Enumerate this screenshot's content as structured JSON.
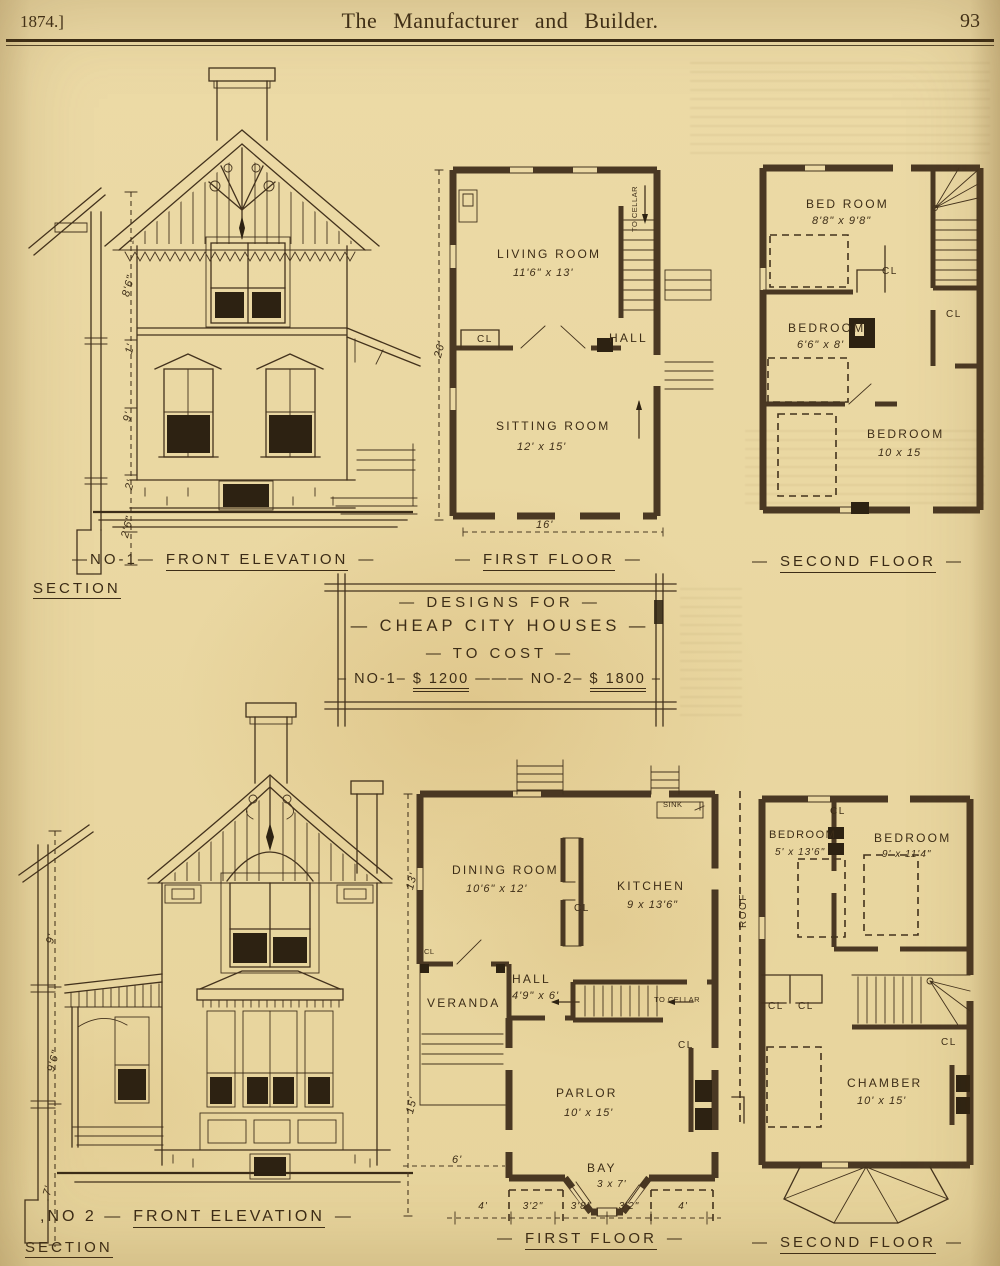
{
  "header": {
    "year": "1874.]",
    "title": "The Manufacturer and Builder.",
    "page_number": "93"
  },
  "title_box": {
    "line1": "— DESIGNS FOR —",
    "line2": "— CHEAP CITY HOUSES —",
    "line3": "— TO COST —",
    "cost1_label": "– NO-1–",
    "cost1_amount": "$ 1200",
    "separator": "———",
    "cost2_label": "NO-2–",
    "cost2_amount": "$ 1800",
    "end_dash": "–"
  },
  "captions": {
    "dash": "—",
    "elev1_no": "—NO-1—",
    "elev2_no": ",NO 2 —",
    "front_elevation": "FRONT ELEVATION",
    "section": "SECTION",
    "first_floor": "FIRST FLOOR",
    "second_floor": "SECOND FLOOR"
  },
  "plan1_first": {
    "living_room": {
      "name": "LIVING ROOM",
      "dims": "11'6\" x 13'"
    },
    "sitting_room": {
      "name": "SITTING ROOM",
      "dims": "12' x 15'"
    },
    "hall": "HALL",
    "closet": "CL",
    "to_cellar": "TO CELLAR",
    "width_dim": "16'",
    "height_dim": "26'"
  },
  "plan1_second": {
    "bedroom1": {
      "name": "BED ROOM",
      "dims": "8'8\" x 9'8\""
    },
    "bedroom2": {
      "name": "BEDROOM",
      "dims": "6'6\" x 8'"
    },
    "bedroom3": {
      "name": "BEDROOM",
      "dims": "10 x 15"
    },
    "closet": "CL"
  },
  "plan2_first": {
    "dining_room": {
      "name": "DINING ROOM",
      "dims": "10'6\" x 12'"
    },
    "kitchen": {
      "name": "KITCHEN",
      "dims": "9 x 13'6\""
    },
    "hall": {
      "name": "HALL",
      "dims": "4'9\" x 6'"
    },
    "veranda": "VERANDA",
    "parlor": {
      "name": "PARLOR",
      "dims": "10' x 15'"
    },
    "bay": {
      "name": "BAY",
      "dims": "3 x 7'"
    },
    "sink": "SINK",
    "to_cellar": "TO CELLAR",
    "closet": "CL",
    "left_dim_top": "13'",
    "left_dim_bottom": "15'",
    "veranda_dim": "6'",
    "bottom_dims": [
      "4'",
      "3'2\"",
      "3'8\"",
      "3'2\"",
      "4'"
    ]
  },
  "plan2_second": {
    "bedroom1": {
      "name": "BEDROOM",
      "dims": "5' x 13'6\""
    },
    "bedroom2": {
      "name": "BEDROOM",
      "dims": "9' x 11'4\""
    },
    "chamber": {
      "name": "CHAMBER",
      "dims": "10' x 15'"
    },
    "roof": "ROOF",
    "closet": "CL"
  },
  "sections": {
    "no1_dims": [
      "8'6\"",
      "1'",
      "9'",
      "2'",
      "2'6\""
    ],
    "no2_dims": [
      "9'",
      "9'6\"",
      "7'"
    ]
  }
}
